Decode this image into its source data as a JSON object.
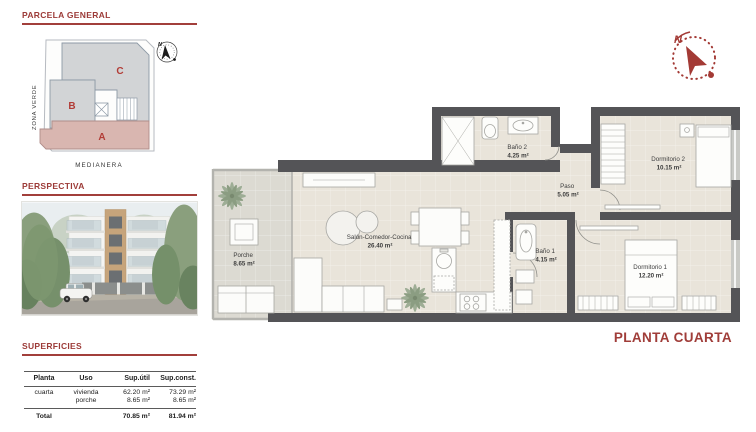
{
  "colors": {
    "accent": "#9c3a37",
    "wall": "#545457",
    "floor": "#e9e4da",
    "porch_floor": "#dcdad2",
    "block_gray": "#d2d4d6",
    "block_pink": "#d9b6b0"
  },
  "parcela": {
    "title": "PARCELA GENERAL",
    "zona_label": "ZONA VERDE",
    "medianera_label": "MEDIANERA",
    "block_a": "A",
    "block_b": "B",
    "block_c": "C",
    "compass_n": "N"
  },
  "perspectiva": {
    "title": "PERSPECTIVA"
  },
  "superficies": {
    "title": "SUPERFICIES",
    "headers": [
      "Planta",
      "Uso",
      "Sup.útil",
      "Sup.const."
    ],
    "row": {
      "planta": "cuarta",
      "uso": [
        "vivienda",
        "porche"
      ],
      "util": [
        "62.20 m²",
        "8.65 m²"
      ],
      "constr": [
        "73.29 m²",
        "8.65 m²"
      ]
    },
    "total": {
      "label": "Total",
      "util": "70.85 m²",
      "constr": "81.94 m²"
    }
  },
  "floorplan": {
    "title": "PLANTA CUARTA",
    "compass_n": "N",
    "rooms": [
      {
        "name": "Porche",
        "area": "8.65 m²"
      },
      {
        "name": "Salón-Comedor-Cocina",
        "area": "26.40 m²"
      },
      {
        "name": "Baño 2",
        "area": "4.25 m²"
      },
      {
        "name": "Paso",
        "area": "5.05 m²"
      },
      {
        "name": "Dormitorio 2",
        "area": "10.15 m²"
      },
      {
        "name": "Baño 1",
        "area": "4.15 m²"
      },
      {
        "name": "Dormitorio 1",
        "area": "12.20 m²"
      }
    ]
  }
}
